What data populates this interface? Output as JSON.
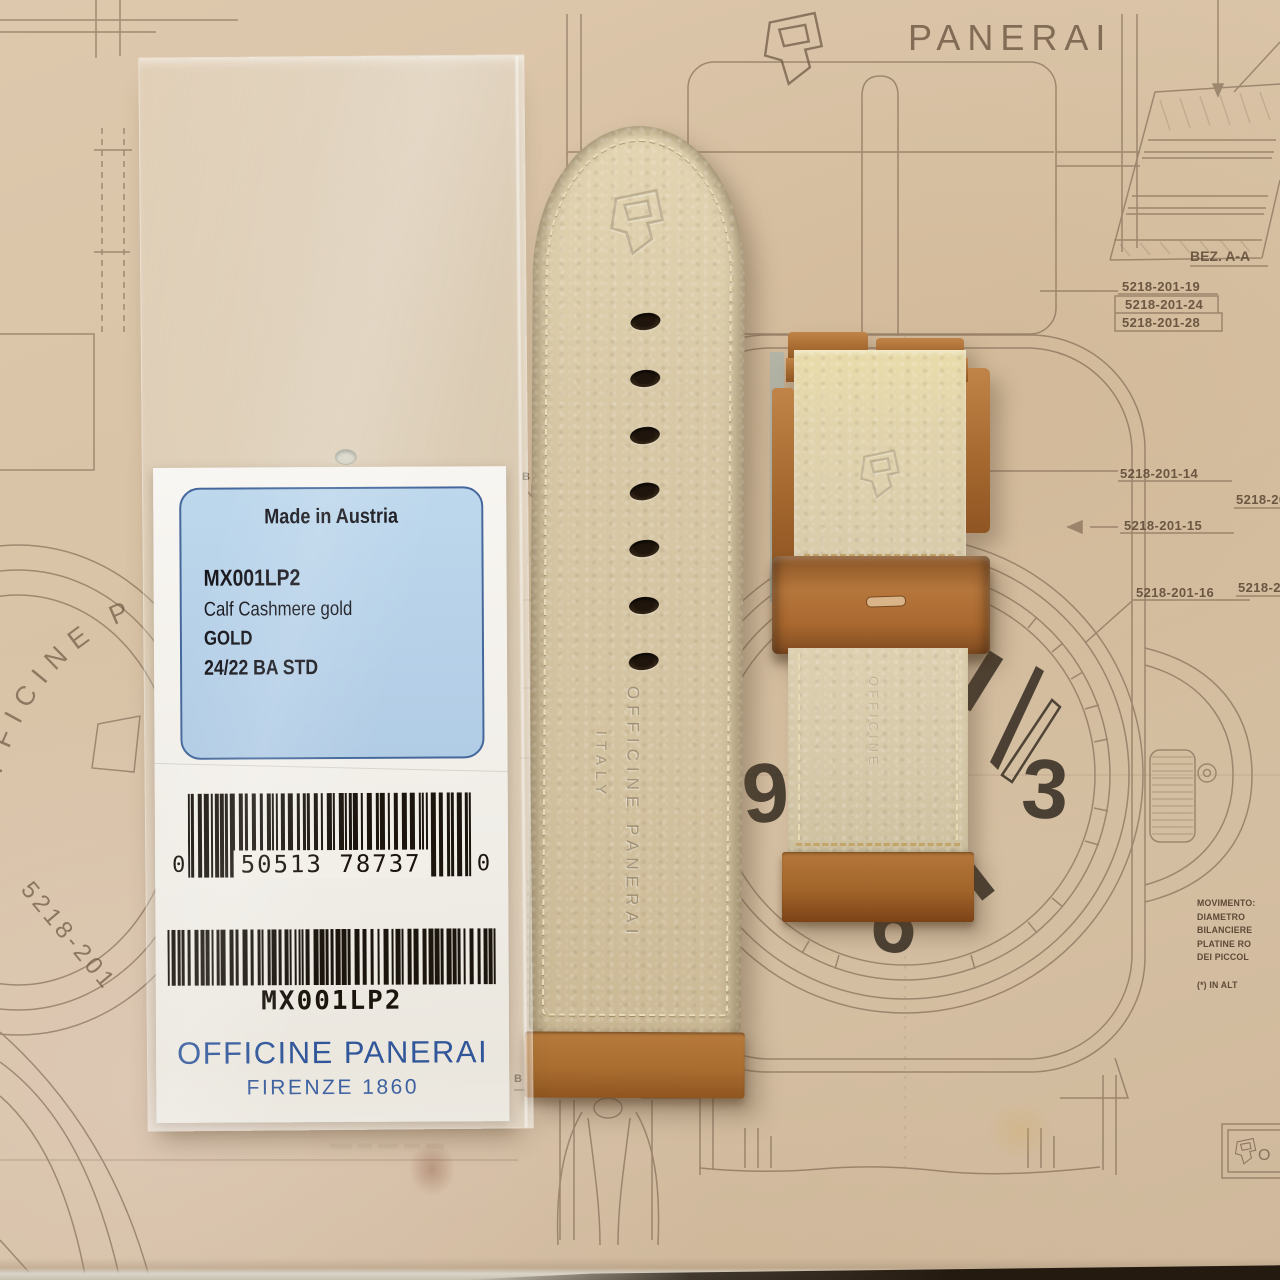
{
  "blueprint": {
    "brand_text": "PANERAI",
    "section_label": "BEZ. A-A",
    "part_numbers": [
      "5218-201-19",
      "5218-201-24",
      "5218-201-28",
      "5218-201-14",
      "5218-201-15",
      "5218-201-16"
    ],
    "edge_numbers": [
      "5218-201",
      "5218-20"
    ],
    "diagonal_number": "5218-201",
    "arc_text": "OFFICINE PA",
    "dial_numbers": {
      "nine": "9",
      "three": "3",
      "six": "6"
    },
    "b_marker": "B",
    "title_block_text": "O",
    "notes": [
      "MOVIMENTO:",
      "DIAMETRO",
      "BILANCIERE",
      "PLATINE RO",
      "DEI PICCOL",
      "(*) IN ALT"
    ]
  },
  "bag_label": {
    "made_in": "Made in Austria",
    "sku": "MX001LP2",
    "material": "Calf Cashmere gold",
    "color_name": "GOLD",
    "size_spec": "24/22 BA STD",
    "barcode_upc": {
      "left_digit": "0",
      "digits": "50513 78737",
      "right_digit": "0"
    },
    "barcode_sku": "MX001LP2",
    "brand_line1": "OFFICINE PANERAI",
    "brand_line2": "FIRENZE 1860"
  },
  "straps": {
    "long": {
      "embossed_line1": "OFFICINE PANERAI",
      "embossed_line2": "ITALY"
    },
    "short": {
      "embossed_text": "OFFICINE"
    }
  },
  "colors": {
    "paper": "#d9c3a7",
    "blueprint_ink": "#6e5844",
    "label_box_bg": "#b7d1e9",
    "label_box_border": "#44689c",
    "brand_blue": "#31579a",
    "leather_cream": "#d7c7a5",
    "leather_brown": "#a96e33"
  }
}
